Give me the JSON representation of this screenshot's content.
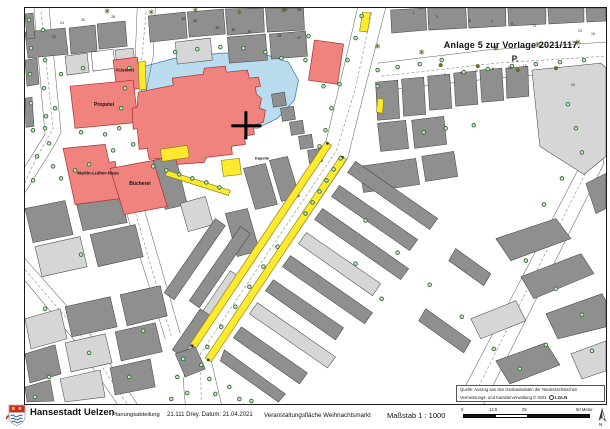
{
  "annotation": {
    "line1": "Anlage 5 zur Vorlage 2021/117.",
    "line2": "P."
  },
  "map_labels": {
    "kuesterei": "Küsterei",
    "propstei": "Propstei",
    "martin_luther_haus": "Martin-Luther-Haus",
    "buecherei": "Bücherei",
    "kapelle": "Kapelle"
  },
  "source_note": {
    "line1": "Quelle: Auszug aus den Geobasisdaten der Niedersächsischen",
    "line2": "Vermessungs- und Katasterverwaltung   © 2021",
    "brand": "LGLN"
  },
  "footer": {
    "city": "Hansestadt Uelzen",
    "dept": "Planungsabteilung",
    "ref": "21.111 Drey. Datum: 21.04.2021",
    "subject": "Veranstaltungsfläche Weihnachtsmarkt",
    "scale": "Maßstab 1 : 1000",
    "scalebar_labels": [
      "0",
      "12.5",
      "25",
      "50 Meter"
    ],
    "north_label": "N"
  },
  "colors": {
    "building_gray": "#8f8f8f",
    "building_light": "#d6d6d6",
    "building_white": "#ffffff",
    "building_stroke": "#3c3c3c",
    "public_red": "#f0837e",
    "public_red_stroke": "#a53030",
    "water_blue": "#badcef",
    "water_stroke": "#3a6ea8",
    "event_yellow": "#ffe92e",
    "event_stroke": "#7a7a10",
    "tree_stroke": "#2e6e2e",
    "tree_fill": "#cde6cd",
    "star_olive": "#6b6b1f",
    "street_line": "#5a5a5a",
    "dash_line": "#8a8a8a",
    "number_color": "#222222"
  },
  "map_features": {
    "pond": "112,60 150,50 196,45 236,45 263,54 273,72 269,92 252,110 232,120 210,118 180,108 150,96 120,86 108,74",
    "church": "113,84 148,77 147,70 178,66 179,60 200,58 201,64 222,62 224,70 233,69 235,78 230,79 231,86 236,90 234,100 240,102 238,114 228,117 229,126 219,128 220,136 206,138 207,146 181,149 179,154 152,156 150,149 124,151 122,140 114,141 112,120 108,121 107,100 112,99",
    "church_cross": {
      "hx": 206,
      "hy": 116,
      "hw": 30,
      "hh": 3,
      "vx": 219,
      "vy": 103,
      "vw": 3,
      "vh": 28
    },
    "street_edges": [
      "M9,0 L20,126 L0,158",
      "M24,0 L36,124 L30,136 L0,184",
      "M112,0 L110,50 L104,92",
      "M130,0 L128,48 L120,88",
      "M332,0 L318,60 L300,135 L165,338 L158,372 L160,395",
      "M360,0 L342,70 L322,150 L186,352 L196,395",
      "M352,55 L460,42 L580,34",
      "M360,82 L470,70 L580,62",
      "M535,72 L558,150 L432,392",
      "M558,75 L578,155 L458,395",
      "M0,250 L60,318 L112,395",
      "M0,272 L48,330 L92,395",
      "M100,200 L140,330",
      "M118,197 L155,325"
    ],
    "dashed_lines": [
      "M16,4 L28,120 L10,152 L0,174",
      "M121,4 L116,56",
      "M346,4 L330,80 L311,142 L175,345 L176,392",
      "M356,68 L470,55 L580,48",
      "M546,74 L566,152 L445,393",
      "M0,261 L54,324 L102,395",
      "M109,200 L146,327"
    ],
    "buildings": [
      {
        "p": "0,24 40,20 43,46 3,50",
        "f": "g"
      },
      {
        "p": "44,20 70,17 72,43 46,46",
        "f": "g"
      },
      {
        "p": "72,16 100,13 102,38 74,41",
        "f": "g"
      },
      {
        "p": "0,6 8,5 10,30 2,31",
        "f": "g"
      },
      {
        "p": "0,90 7,89 9,118 1,119",
        "f": "g"
      },
      {
        "p": "0,52 12,50 14,76 2,78",
        "f": "g"
      },
      {
        "p": "40,48 62,45 64,64 42,67",
        "f": "l"
      },
      {
        "p": "66,44 88,41 90,60 68,63",
        "f": "w"
      },
      {
        "p": "90,42 108,40 110,58 92,60",
        "f": "l"
      },
      {
        "p": "123,8 160,4 162,30 125,34",
        "f": "g"
      },
      {
        "p": "162,4 198,1 200,26 164,29",
        "f": "g"
      },
      {
        "p": "200,1 238,0 239,24 202,27",
        "f": "g"
      },
      {
        "p": "240,0 278,0 279,22 242,24",
        "f": "g"
      },
      {
        "p": "150,34 185,30 187,52 152,56",
        "f": "l"
      },
      {
        "p": "202,29 240,26 242,52 204,55",
        "f": "g"
      },
      {
        "p": "244,26 280,23 282,48 246,51",
        "f": "g"
      },
      {
        "p": "365,2 400,0 401,22 366,25",
        "f": "g"
      },
      {
        "p": "402,0 440,0 441,20 403,22",
        "f": "g"
      },
      {
        "p": "442,0 480,0 480,18 443,20",
        "f": "g"
      },
      {
        "p": "482,0 520,0 520,16 483,18",
        "f": "g"
      },
      {
        "p": "522,0 558,0 558,14 523,16",
        "f": "g"
      },
      {
        "p": "560,0 580,0 580,13 561,14",
        "f": "g"
      },
      {
        "p": "350,74 372,72 374,110 352,112",
        "f": "g"
      },
      {
        "p": "376,71 398,69 400,106 378,108",
        "f": "g"
      },
      {
        "p": "402,68 424,66 426,100 404,102",
        "f": "g"
      },
      {
        "p": "428,65 450,63 452,96 430,98",
        "f": "g"
      },
      {
        "p": "454,62 476,60 478,92 456,94",
        "f": "g"
      },
      {
        "p": "480,60 502,58 503,88 481,90",
        "f": "g"
      },
      {
        "p": "506,62 575,55 580,60 580,148 558,166 514,138",
        "f": "l"
      },
      {
        "p": "352,115 380,112 383,140 355,143",
        "f": "g"
      },
      {
        "p": "386,112 418,108 421,136 389,140",
        "f": "g"
      },
      {
        "p": "334,158 390,150 394,176 338,184",
        "f": "g"
      },
      {
        "p": "396,148 428,143 432,168 400,173",
        "f": "g"
      },
      {
        "p": "246,86 259,84 261,97 248,99",
        "f": "g"
      },
      {
        "p": "255,100 268,98 270,111 257,113",
        "f": "g"
      },
      {
        "p": "264,114 277,112 279,125 266,127",
        "f": "g"
      },
      {
        "p": "273,128 286,126 288,139 275,141",
        "f": "g"
      },
      {
        "p": "282,142 295,140 297,153 284,155",
        "f": "g"
      },
      {
        "p": "128,152 150,147 162,196 140,201",
        "f": "g"
      },
      {
        "p": "155,195 180,188 188,216 163,223",
        "f": "l"
      },
      {
        "p": "218,160 240,155 252,196 230,201",
        "f": "g"
      },
      {
        "p": "244,152 262,148 274,188 256,193",
        "f": "g"
      },
      {
        "p": "200,205 222,200 234,242 212,248",
        "f": "g"
      },
      {
        "p": "330,153 412,210 404,221 322,164",
        "f": "g"
      },
      {
        "p": "314,177 392,231 384,242 306,188",
        "f": "g"
      },
      {
        "p": "297,200 383,260 375,271 289,211",
        "f": "g"
      },
      {
        "p": "281,224 355,275 347,287 273,235",
        "f": "l"
      },
      {
        "p": "265,247 347,304 339,315 257,258",
        "f": "g"
      },
      {
        "p": "248,271 318,319 310,331 240,282",
        "f": "g"
      },
      {
        "p": "232,294 310,348 302,359 224,305",
        "f": "l"
      },
      {
        "p": "216,318 282,364 274,375 208,329",
        "f": "g"
      },
      {
        "p": "199,341 260,385 253,393 195,352",
        "f": "g"
      },
      {
        "p": "430,240 465,265 458,277 423,252",
        "f": "g"
      },
      {
        "p": "400,300 445,332 438,344 393,312",
        "f": "g"
      },
      {
        "p": "470,230 530,210 545,230 485,252",
        "f": "g"
      },
      {
        "p": "495,268 555,245 568,265 508,290",
        "f": "g"
      },
      {
        "p": "520,305 576,285 580,292 580,318 532,330",
        "f": "g"
      },
      {
        "p": "545,345 580,332 580,362 556,370",
        "f": "l"
      },
      {
        "p": "470,352 520,334 534,356 484,375",
        "f": "g"
      },
      {
        "p": "445,310 490,292 500,312 455,330",
        "f": "l"
      },
      {
        "p": "560,175 580,165 580,200 570,205",
        "f": "g"
      },
      {
        "p": "0,200 40,192 48,226 8,234",
        "f": "g"
      },
      {
        "p": "50,190 95,182 102,214 58,222",
        "f": "g"
      },
      {
        "p": "10,238 55,228 62,258 17,268",
        "f": "l"
      },
      {
        "p": "65,226 110,216 118,248 73,258",
        "f": "g"
      },
      {
        "p": "0,310 35,300 42,330 6,340",
        "f": "l"
      },
      {
        "p": "40,298 85,288 92,318 47,328",
        "f": "g"
      },
      {
        "p": "95,286 135,277 142,307 102,317",
        "f": "g"
      },
      {
        "p": "0,345 30,336 36,365 5,374",
        "f": "g"
      },
      {
        "p": "40,334 80,325 87,354 46,363",
        "f": "l"
      },
      {
        "p": "90,323 130,314 137,343 96,352",
        "f": "g"
      },
      {
        "p": "0,378 25,371 29,392 2,393",
        "f": "g"
      },
      {
        "p": "35,370 75,361 80,388 40,393",
        "f": "l"
      },
      {
        "p": "85,359 125,350 130,378 90,386",
        "f": "g"
      },
      {
        "p": "190,210 200,217 149,291 139,284",
        "f": "g"
      },
      {
        "p": "215,218 225,225 174,299 164,292",
        "f": "g"
      },
      {
        "p": "205,262 215,269 187,310 177,303",
        "f": "l"
      },
      {
        "p": "175,300 185,307 157,348 147,341",
        "f": "g"
      },
      {
        "p": "150,345 170,338 180,360 160,368",
        "f": "g"
      }
    ],
    "public_buildings": [
      {
        "name": "kuesterei-building",
        "p": "88,52 112,49 116,80 92,84"
      },
      {
        "name": "propstei-building",
        "p": "45,78 108,72 113,114 50,120"
      },
      {
        "name": "martin-luther-haus-building",
        "p": "38,140 80,136 84,154 90,153 96,190 50,196"
      },
      {
        "name": "buecherei-building",
        "p": "85,160 128,152 142,198 99,206"
      },
      {
        "name": "northeast-red-building",
        "p": "289,32 318,36 312,76 283,72"
      }
    ],
    "event_areas": [
      "113,54 120,53 121,81 114,82",
      "337,4 345,5 342,24 334,23",
      "352,90 358,91 357,105 351,104",
      "135,141 162,137 164,149 137,153",
      "142,162 205,182 203,187 140,167",
      "196,152 214,150 216,166 198,168",
      "165,335 300,133 306,137 171,339",
      "180,349 315,147 321,151 186,353"
    ],
    "strip_endcaps": [
      [
        167,
        337
      ],
      [
        183,
        351
      ],
      [
        302,
        135
      ],
      [
        317,
        149
      ]
    ],
    "trees": [
      [
        4,
        12
      ],
      [
        18,
        22
      ],
      [
        6,
        40
      ],
      [
        20,
        52
      ],
      [
        5,
        66
      ],
      [
        19,
        80
      ],
      [
        6,
        95
      ],
      [
        21,
        108
      ],
      [
        8,
        122
      ],
      [
        24,
        135
      ],
      [
        12,
        148
      ],
      [
        28,
        158
      ],
      [
        8,
        172
      ],
      [
        36,
        170
      ],
      [
        50,
        162
      ],
      [
        64,
        156
      ],
      [
        128,
        158
      ],
      [
        141,
        162
      ],
      [
        154,
        166
      ],
      [
        167,
        170
      ],
      [
        181,
        174
      ],
      [
        194,
        179
      ],
      [
        104,
        60
      ],
      [
        100,
        80
      ],
      [
        96,
        100
      ],
      [
        94,
        120
      ],
      [
        108,
        136
      ],
      [
        88,
        142
      ],
      [
        36,
        66
      ],
      [
        58,
        60
      ],
      [
        30,
        100
      ],
      [
        56,
        124
      ],
      [
        80,
        126
      ],
      [
        20,
        120
      ],
      [
        150,
        44
      ],
      [
        172,
        41
      ],
      [
        195,
        39
      ],
      [
        218,
        40
      ],
      [
        240,
        44
      ],
      [
        256,
        50
      ],
      [
        336,
        8
      ],
      [
        330,
        30
      ],
      [
        322,
        52
      ],
      [
        314,
        76
      ],
      [
        306,
        100
      ],
      [
        300,
        122
      ],
      [
        294,
        138
      ],
      [
        352,
        62
      ],
      [
        372,
        59
      ],
      [
        394,
        56
      ],
      [
        416,
        52
      ],
      [
        438,
        64
      ],
      [
        462,
        61
      ],
      [
        486,
        58
      ],
      [
        510,
        56
      ],
      [
        534,
        54
      ],
      [
        558,
        52
      ],
      [
        352,
        78
      ],
      [
        542,
        96
      ],
      [
        550,
        120
      ],
      [
        556,
        144
      ],
      [
        536,
        170
      ],
      [
        518,
        196
      ],
      [
        315,
        150
      ],
      [
        308,
        161
      ],
      [
        301,
        172
      ],
      [
        294,
        183
      ],
      [
        287,
        194
      ],
      [
        280,
        205
      ],
      [
        252,
        238
      ],
      [
        238,
        258
      ],
      [
        224,
        278
      ],
      [
        210,
        298
      ],
      [
        196,
        318
      ],
      [
        182,
        338
      ],
      [
        158,
        350
      ],
      [
        176,
        356
      ],
      [
        152,
        368
      ],
      [
        184,
        370
      ],
      [
        162,
        384
      ],
      [
        190,
        385
      ],
      [
        204,
        378
      ],
      [
        214,
        390
      ],
      [
        146,
        390
      ],
      [
        226,
        392
      ],
      [
        340,
        212
      ],
      [
        372,
        244
      ],
      [
        404,
        276
      ],
      [
        436,
        308
      ],
      [
        468,
        340
      ],
      [
        330,
        255
      ],
      [
        356,
        290
      ],
      [
        500,
        252
      ],
      [
        530,
        280
      ],
      [
        556,
        306
      ],
      [
        520,
        336
      ],
      [
        494,
        360
      ],
      [
        566,
        342
      ],
      [
        56,
        246
      ],
      [
        20,
        300
      ],
      [
        118,
        322
      ],
      [
        64,
        344
      ],
      [
        24,
        368
      ],
      [
        104,
        368
      ],
      [
        10,
        388
      ],
      [
        283,
        28
      ],
      [
        280,
        52
      ],
      [
        298,
        78
      ],
      [
        420,
        120
      ],
      [
        448,
        117
      ],
      [
        398,
        124
      ]
    ],
    "stars": [
      [
        82,
        3
      ],
      [
        126,
        4
      ],
      [
        170,
        2
      ],
      [
        214,
        4
      ],
      [
        258,
        2
      ],
      [
        352,
        38
      ],
      [
        396,
        44
      ],
      [
        470,
        40
      ],
      [
        512,
        36
      ],
      [
        552,
        34
      ]
    ],
    "bushes": [
      [
        452,
        58
      ],
      [
        492,
        62
      ],
      [
        530,
        60
      ],
      [
        415,
        57
      ]
    ],
    "house_numbers": [
      [
        27,
        30,
        "22"
      ],
      [
        35,
        16,
        "24"
      ],
      [
        56,
        13,
        "26"
      ],
      [
        86,
        10,
        "28"
      ],
      [
        156,
        12,
        "30"
      ],
      [
        168,
        14,
        "32"
      ],
      [
        190,
        21,
        "34"
      ],
      [
        206,
        23,
        "36"
      ],
      [
        222,
        25,
        "38"
      ],
      [
        252,
        29,
        "45"
      ],
      [
        272,
        31,
        "47"
      ],
      [
        258,
        3,
        "53"
      ],
      [
        272,
        3,
        "55"
      ],
      [
        387,
        6,
        "1"
      ],
      [
        410,
        10,
        "3"
      ],
      [
        443,
        14,
        "5"
      ],
      [
        465,
        15,
        "7"
      ],
      [
        485,
        17,
        "9"
      ],
      [
        507,
        19,
        "11"
      ],
      [
        552,
        24,
        "13"
      ],
      [
        565,
        27,
        "15"
      ],
      [
        418,
        68,
        "2"
      ],
      [
        434,
        66,
        "4"
      ],
      [
        450,
        64,
        "6"
      ],
      [
        466,
        62,
        "8"
      ],
      [
        482,
        61,
        "10"
      ],
      [
        497,
        59,
        "12"
      ],
      [
        545,
        78,
        "20"
      ]
    ]
  }
}
